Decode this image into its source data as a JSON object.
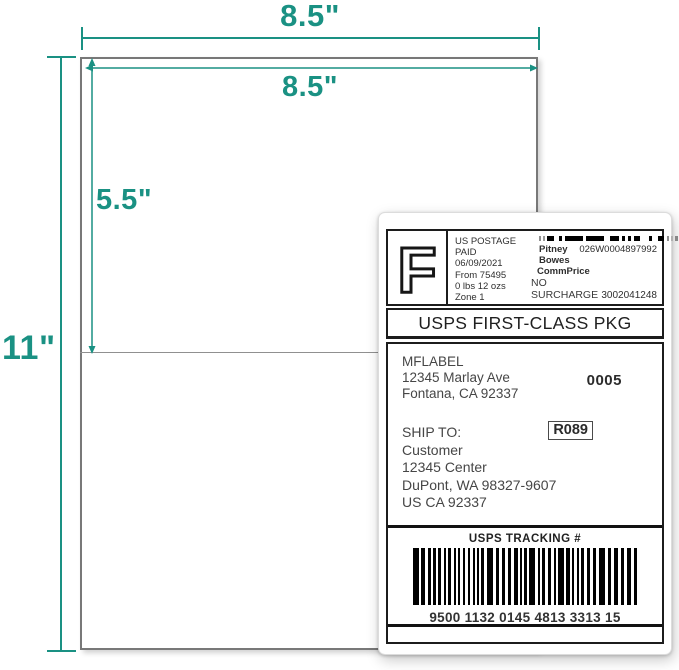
{
  "colors": {
    "accent": "#1a9183",
    "label_ink": "#1c1c1c"
  },
  "dims": {
    "sheet_width": "8.5\"",
    "label_width": "8.5\"",
    "label_height": "5.5\"",
    "sheet_height": "11\""
  },
  "label": {
    "postage": {
      "indicia_letter": "F",
      "line1": "US POSTAGE",
      "line2": "PAID",
      "line3": "06/09/2021",
      "line4": "From 75495",
      "line5": "0 lbs 12 ozs",
      "line6": "Zone 1",
      "carrier": "Pitney Bowes",
      "meter_id": "026W0004897992",
      "rate": "CommPrice",
      "surcharge": "NO SURCHARGE",
      "account": "3002041248"
    },
    "service": "USPS FIRST-CLASS PKG",
    "sender": {
      "name": "MFLABEL",
      "street": "12345 Marlay Ave",
      "city": "Fontana, CA 92337",
      "batch": "0005"
    },
    "recipient": {
      "heading": "SHIP TO:",
      "name": "Customer",
      "street": "12345 Center",
      "city": "DuPont, WA 98327-9607",
      "country": "US CA 92337",
      "route": "R089"
    },
    "tracking": {
      "heading": "USPS TRACKING #",
      "number": "9500 1132 0145 4813 3313 15"
    }
  }
}
